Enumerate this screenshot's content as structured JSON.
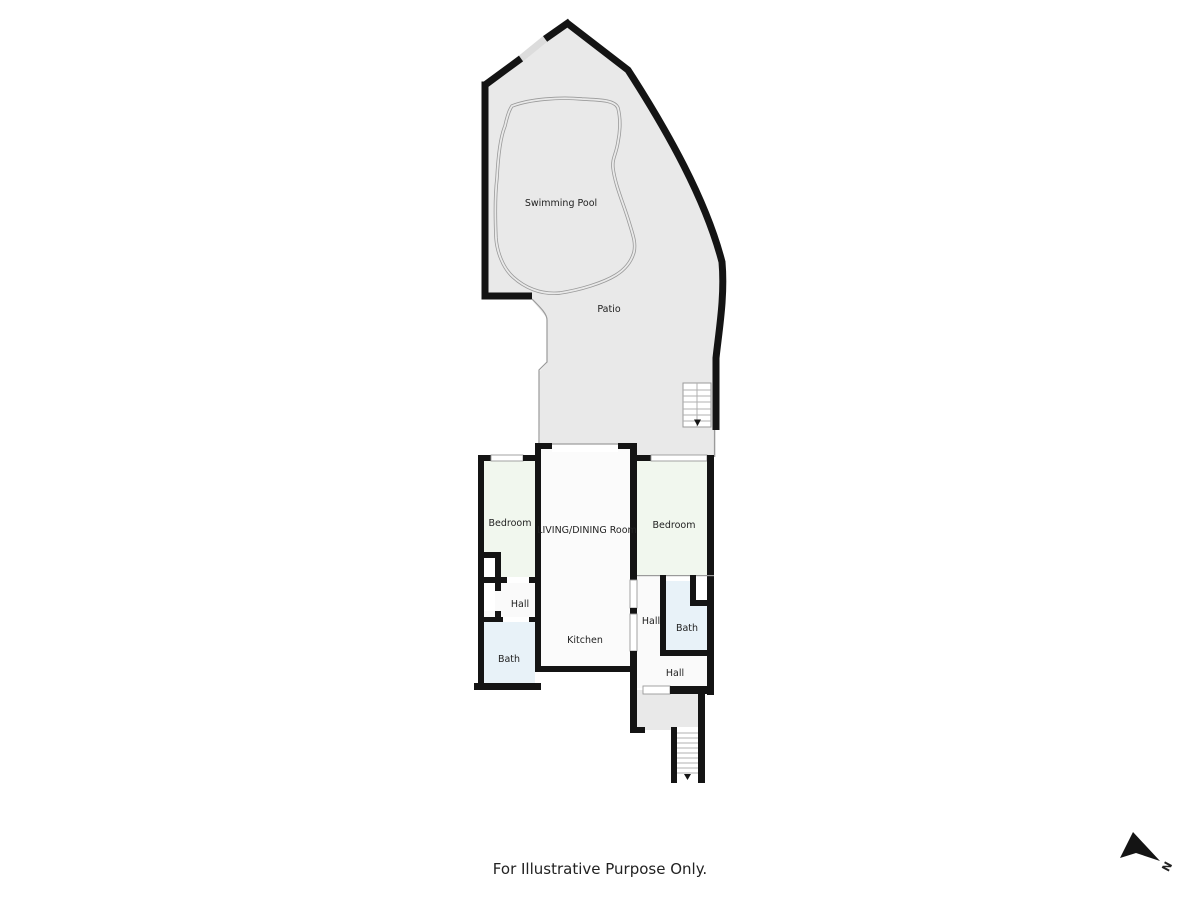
{
  "colors": {
    "wall": "#141414",
    "patio": "#e9e9e9",
    "bedroom": "#f1f7ee",
    "bath": "#e8f2f8",
    "room": "#fbfbfb",
    "hall": "#fafafa",
    "line": "#9a9a9a",
    "gate": "#dcdcdc",
    "text": "#222222"
  },
  "rooms": {
    "swimming_pool": "Swimming Pool",
    "patio": "Patio",
    "bedroom_left": "Bedroom",
    "bedroom_right": "Bedroom",
    "living_dining": "LIVING/DINING Room",
    "kitchen": "Kitchen",
    "hall_left": "Hall",
    "hall_middle": "Hall",
    "hall_lower": "Hall",
    "bath_left": "Bath",
    "bath_right": "Bath"
  },
  "footer": {
    "disclaimer": "For Illustrative Purpose Only."
  },
  "compass": {
    "north_label": "N"
  }
}
